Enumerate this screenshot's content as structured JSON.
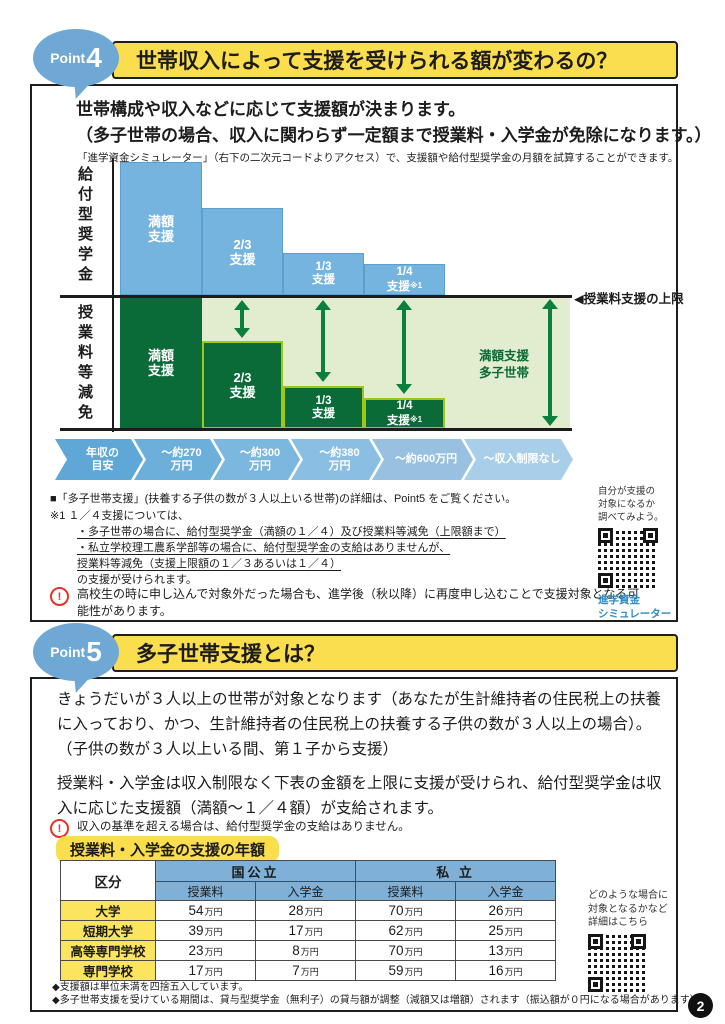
{
  "page_number": "2",
  "colors": {
    "title_yellow": "#FBDE4E",
    "badge_blue": "#6FA8D4",
    "bar_blue": "#75B4DF",
    "bar_dark_green": "#0A6B38",
    "area_light_green": "#E2ECCE",
    "arrow_green": "#0B7F3E",
    "table_header_blue": "#7FB0D8",
    "row_label_yellow": "#FBE45E",
    "warning_red": "#E5332A",
    "link_blue": "#2E8BC5"
  },
  "point4": {
    "badge": {
      "prefix": "Point",
      "number": "4"
    },
    "title": "世帯収入によって支援を受けられる額が変わるの？",
    "lead1": "世帯構成や収入などに応じて支援額が決まります。",
    "lead2": "（多子世帯の場合、収入に関わらず一定額まで授業料・入学金が免除になります。）",
    "subnote": "「進学資金シミュレーター」（右下の二次元コードよりアクセス）で、支援額や給付型奨学金の月額を試算することができます。",
    "chart": {
      "type": "bar",
      "axis_top_label": "給付型奨学金",
      "axis_bottom_label": "授業料等減免",
      "limit_label": "◀授業料支援の上限",
      "support_fractions": [
        1,
        0.667,
        0.333,
        0.25
      ],
      "top_bars": [
        {
          "l1": "満額",
          "l2": "支援"
        },
        {
          "l1": "2/3",
          "l2": "支援"
        },
        {
          "l1": "1/3",
          "l2": "支援"
        },
        {
          "l1": "1/4",
          "l2": "支援",
          "sup": "※1"
        }
      ],
      "bottom_bars": [
        {
          "l1": "満額",
          "l2": "支援"
        },
        {
          "l1": "2/3",
          "l2": "支援"
        },
        {
          "l1": "1/3",
          "l2": "支援"
        },
        {
          "l1": "1/4",
          "l2": "支援",
          "sup": "※1"
        }
      ],
      "multi_child_full": {
        "line1": "満額支援",
        "line2": "多子世帯"
      },
      "income_axis": [
        {
          "line1": "年収の",
          "line2": "目安"
        },
        {
          "line1": "～約270",
          "line2": "万円"
        },
        {
          "line1": "～約300",
          "line2": "万円"
        },
        {
          "line1": "～約380",
          "line2": "万円"
        },
        {
          "line1": "～約600万円"
        },
        {
          "line1": "～収入制限なし"
        }
      ]
    },
    "notes": {
      "line1": "■「多子世帯支援」(扶養する子供の数が３人以上いる世帯)の詳細は、Point5 をご覧ください。",
      "line2": "※1 １／４支援については、",
      "bullet1": "・多子世帯の場合に、給付型奨学金（満額の１／４）及び授業料等減免（上限額まで）",
      "bullet2": "・私立学校理工農系学部等の場合に、給付型奨学金の支給はありませんが、",
      "bullet3": "授業料等減免（支援上限額の１／３あるいは１／４）",
      "tail": "の支援が受けられます。"
    },
    "warning": "高校生の時に申し込んで対象外だった場合も、進学後（秋以降）に再度申し込むことで支援対象となる可能性があります。",
    "qr": {
      "caption1": "自分が支援の",
      "caption2": "対象になるか",
      "caption3": "調べてみよう。",
      "label1": "進学資金",
      "label2": "シミュレーター"
    }
  },
  "point5": {
    "badge": {
      "prefix": "Point",
      "number": "5"
    },
    "title": "多子世帯支援とは？",
    "para1": "きょうだいが３人以上の世帯が対象となります（あなたが生計維持者の住民税上の扶養に入っており、かつ、生計維持者の住民税上の扶養する子供の数が３人以上の場合）。",
    "para1b": "（子供の数が３人以上いる間、第１子から支援）",
    "para2": "授業料・入学金は収入制限なく下表の金額を上限に支援が受けられ、給付型奨学金は収入に応じた支援額（満額～１／４額）が支給されます。",
    "warning": "収入の基準を超える場合は、給付型奨学金の支給はありません。",
    "table": {
      "title": "授業料・入学金の支援の年額",
      "corner": "区分",
      "group_headers": [
        "国公立",
        "私 立"
      ],
      "sub_headers": [
        "授業料",
        "入学金",
        "授業料",
        "入学金"
      ],
      "unit": "万円",
      "rows": [
        {
          "label": "大学",
          "values": [
            "54",
            "28",
            "70",
            "26"
          ]
        },
        {
          "label": "短期大学",
          "values": [
            "39",
            "17",
            "62",
            "25"
          ]
        },
        {
          "label": "高等専門学校",
          "values": [
            "23",
            "8",
            "70",
            "13"
          ]
        },
        {
          "label": "専門学校",
          "values": [
            "17",
            "7",
            "59",
            "16"
          ]
        }
      ]
    },
    "footnote1": "◆支援額は単位未満を四捨五入しています。",
    "footnote2": "◆多子世帯支援を受けている期間は、貸与型奨学金（無利子）の貸与額が調整（減額又は増額）されます（振込額が０円になる場合があります）。",
    "qr": {
      "caption1": "どのような場合に",
      "caption2": "対象となるかなど",
      "caption3": "詳細はこちら"
    }
  }
}
